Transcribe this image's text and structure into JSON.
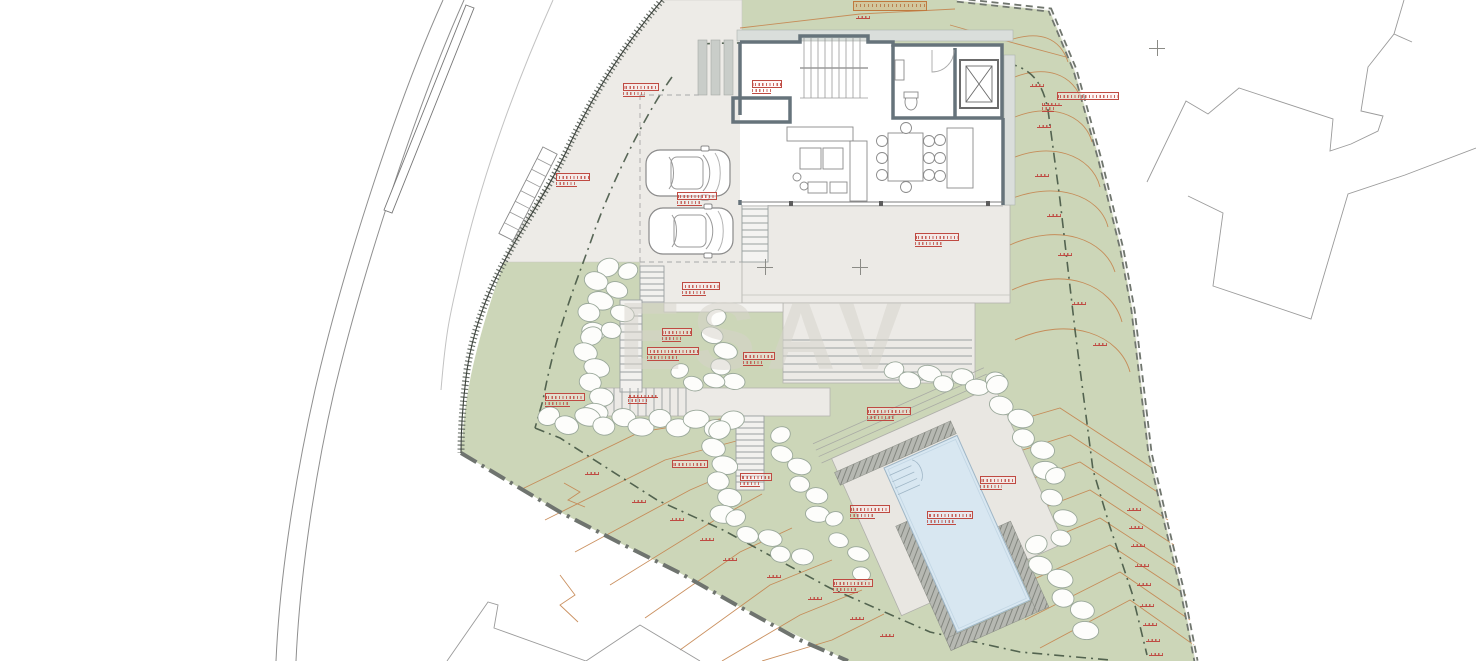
{
  "meta": {
    "type": "architectural-site-plan",
    "watermark": "ESAV"
  },
  "colors": {
    "lawn_green": "#ccd6b8",
    "court_gray": "#edebe7",
    "terrace_gray": "#eceae6",
    "pool_blue": "#d8e7f1",
    "hatch_gray": "#b6b8b2",
    "contour_orange": "#c5854f",
    "annotation_red": "#bf4a42",
    "boundary_dark": "#5b635b",
    "wall_gray": "#66737b"
  },
  "annotations": [
    {
      "x": 853,
      "y": 1,
      "w": 74,
      "style": "boxed-orange"
    },
    {
      "x": 856,
      "y": 14,
      "w": 14,
      "style": "tick"
    },
    {
      "x": 1057,
      "y": 92,
      "w": 62,
      "style": "boxed1"
    },
    {
      "x": 1042,
      "y": 101,
      "w": 20,
      "style": "lines2"
    },
    {
      "x": 623,
      "y": 83,
      "w": 36,
      "style": "boxed2"
    },
    {
      "x": 752,
      "y": 80,
      "w": 30,
      "style": "boxed2"
    },
    {
      "x": 556,
      "y": 173,
      "w": 34,
      "style": "boxed2"
    },
    {
      "x": 677,
      "y": 192,
      "w": 40,
      "style": "boxed2"
    },
    {
      "x": 915,
      "y": 233,
      "w": 44,
      "style": "boxed2"
    },
    {
      "x": 682,
      "y": 282,
      "w": 38,
      "style": "boxed2"
    },
    {
      "x": 662,
      "y": 328,
      "w": 30,
      "style": "boxed2"
    },
    {
      "x": 647,
      "y": 347,
      "w": 52,
      "style": "boxed2"
    },
    {
      "x": 743,
      "y": 352,
      "w": 32,
      "style": "boxed2"
    },
    {
      "x": 545,
      "y": 393,
      "w": 40,
      "style": "boxed2"
    },
    {
      "x": 628,
      "y": 393,
      "w": 30,
      "style": "lines2"
    },
    {
      "x": 672,
      "y": 460,
      "w": 36,
      "style": "boxed1"
    },
    {
      "x": 740,
      "y": 473,
      "w": 32,
      "style": "boxed2"
    },
    {
      "x": 867,
      "y": 407,
      "w": 44,
      "style": "boxed2"
    },
    {
      "x": 850,
      "y": 505,
      "w": 40,
      "style": "boxed2"
    },
    {
      "x": 980,
      "y": 476,
      "w": 36,
      "style": "boxed2"
    },
    {
      "x": 927,
      "y": 511,
      "w": 46,
      "style": "boxed2"
    },
    {
      "x": 833,
      "y": 579,
      "w": 40,
      "style": "boxed2"
    },
    {
      "x": 1030,
      "y": 82,
      "w": 14,
      "style": "tick"
    },
    {
      "x": 1037,
      "y": 123,
      "w": 14,
      "style": "tick"
    },
    {
      "x": 1035,
      "y": 172,
      "w": 14,
      "style": "tick"
    },
    {
      "x": 1047,
      "y": 212,
      "w": 14,
      "style": "tick"
    },
    {
      "x": 1058,
      "y": 251,
      "w": 14,
      "style": "tick"
    },
    {
      "x": 1072,
      "y": 300,
      "w": 14,
      "style": "tick"
    },
    {
      "x": 1093,
      "y": 341,
      "w": 14,
      "style": "tick"
    },
    {
      "x": 1127,
      "y": 506,
      "w": 14,
      "style": "tick"
    },
    {
      "x": 1129,
      "y": 524,
      "w": 14,
      "style": "tick"
    },
    {
      "x": 1131,
      "y": 542,
      "w": 14,
      "style": "tick"
    },
    {
      "x": 1135,
      "y": 562,
      "w": 14,
      "style": "tick"
    },
    {
      "x": 1137,
      "y": 581,
      "w": 14,
      "style": "tick"
    },
    {
      "x": 1140,
      "y": 602,
      "w": 14,
      "style": "tick"
    },
    {
      "x": 1143,
      "y": 621,
      "w": 14,
      "style": "tick"
    },
    {
      "x": 1146,
      "y": 637,
      "w": 14,
      "style": "tick"
    },
    {
      "x": 1149,
      "y": 651,
      "w": 14,
      "style": "tick"
    },
    {
      "x": 585,
      "y": 470,
      "w": 14,
      "style": "tick"
    },
    {
      "x": 632,
      "y": 498,
      "w": 14,
      "style": "tick"
    },
    {
      "x": 670,
      "y": 516,
      "w": 14,
      "style": "tick"
    },
    {
      "x": 700,
      "y": 536,
      "w": 14,
      "style": "tick"
    },
    {
      "x": 723,
      "y": 556,
      "w": 14,
      "style": "tick"
    },
    {
      "x": 767,
      "y": 573,
      "w": 14,
      "style": "tick"
    },
    {
      "x": 808,
      "y": 595,
      "w": 14,
      "style": "tick"
    },
    {
      "x": 850,
      "y": 615,
      "w": 14,
      "style": "tick"
    },
    {
      "x": 880,
      "y": 632,
      "w": 14,
      "style": "tick"
    }
  ],
  "crosshairs": [
    {
      "x": 765,
      "y": 267
    },
    {
      "x": 860,
      "y": 267
    },
    {
      "x": 1157,
      "y": 48
    }
  ],
  "boulder_chains": [
    {
      "x1": 604,
      "y1": 268,
      "x2": 590,
      "y2": 330,
      "n": 5,
      "r": 11
    },
    {
      "x1": 624,
      "y1": 272,
      "x2": 616,
      "y2": 332,
      "n": 4,
      "r": 10
    },
    {
      "x1": 588,
      "y1": 338,
      "x2": 600,
      "y2": 412,
      "n": 6,
      "r": 11
    },
    {
      "x1": 550,
      "y1": 420,
      "x2": 733,
      "y2": 424,
      "n": 11,
      "r": 11
    },
    {
      "x1": 716,
      "y1": 432,
      "x2": 728,
      "y2": 514,
      "n": 6,
      "r": 11
    },
    {
      "x1": 735,
      "y1": 522,
      "x2": 800,
      "y2": 560,
      "n": 5,
      "r": 10
    },
    {
      "x1": 778,
      "y1": 438,
      "x2": 822,
      "y2": 512,
      "n": 6,
      "r": 10
    },
    {
      "x1": 832,
      "y1": 522,
      "x2": 866,
      "y2": 572,
      "n": 4,
      "r": 9
    },
    {
      "x1": 713,
      "y1": 320,
      "x2": 730,
      "y2": 382,
      "n": 5,
      "r": 10
    },
    {
      "x1": 680,
      "y1": 375,
      "x2": 712,
      "y2": 384,
      "n": 3,
      "r": 9
    },
    {
      "x1": 895,
      "y1": 374,
      "x2": 995,
      "y2": 384,
      "n": 7,
      "r": 10
    },
    {
      "x1": 995,
      "y1": 388,
      "x2": 1050,
      "y2": 468,
      "n": 6,
      "r": 11
    },
    {
      "x1": 1052,
      "y1": 478,
      "x2": 1066,
      "y2": 538,
      "n": 4,
      "r": 10
    },
    {
      "x1": 1034,
      "y1": 548,
      "x2": 1090,
      "y2": 628,
      "n": 6,
      "r": 11
    }
  ],
  "cars": [
    {
      "x": 645,
      "y": 147
    },
    {
      "x": 648,
      "y": 205
    }
  ]
}
